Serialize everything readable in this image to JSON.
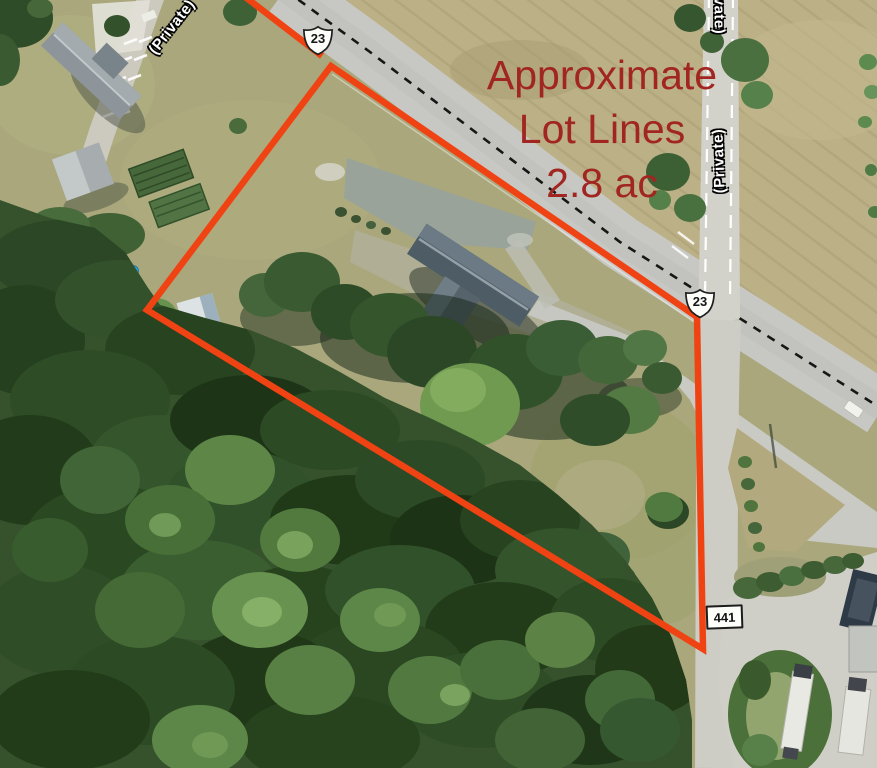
{
  "map": {
    "annotation": {
      "line1": "Approximate",
      "line2": "Lot Lines",
      "line3": "2.8 ac"
    },
    "road_labels": {
      "private_left": "(Private)",
      "private_right_top": "(Private)",
      "private_right_mid": "(Private)"
    },
    "route_shields": {
      "top_shield": "23",
      "middle_shield": "23"
    },
    "address_marker": {
      "text": "441"
    },
    "colors": {
      "lot_line": "#f04314",
      "annotation_text": "#a12622",
      "shield_fill": "#fdfdfa",
      "shield_border": "#1f1f1f"
    }
  }
}
